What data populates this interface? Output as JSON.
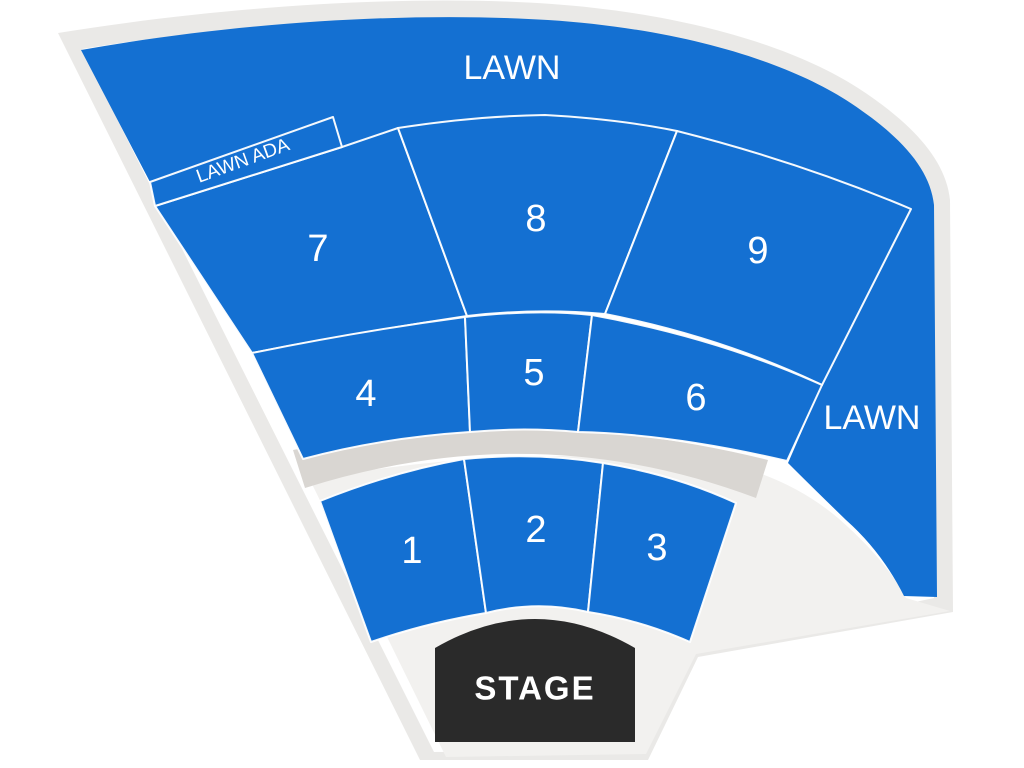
{
  "map": {
    "lawn_top_label": "LAWN",
    "lawn_right_label": "LAWN",
    "lawn_ada_label": "LAWN ADA",
    "stage_label": "STAGE",
    "sections": [
      {
        "id": "1",
        "label": "1"
      },
      {
        "id": "2",
        "label": "2"
      },
      {
        "id": "3",
        "label": "3"
      },
      {
        "id": "4",
        "label": "4"
      },
      {
        "id": "5",
        "label": "5"
      },
      {
        "id": "6",
        "label": "6"
      },
      {
        "id": "7",
        "label": "7"
      },
      {
        "id": "8",
        "label": "8"
      },
      {
        "id": "9",
        "label": "9"
      }
    ],
    "colors": {
      "section_fill": "#1470D2",
      "lawn_fill": "#1470D2",
      "outline_gray": "#EAE9E7",
      "interior_white": "#FFFFFF",
      "bowl_gray": "#F2F1EF",
      "walkway_gray": "#D9D6D2",
      "stage_fill": "#2A2A2A",
      "label_text": "#FFFFFF",
      "divider_lines": "#FFFFFF"
    }
  }
}
